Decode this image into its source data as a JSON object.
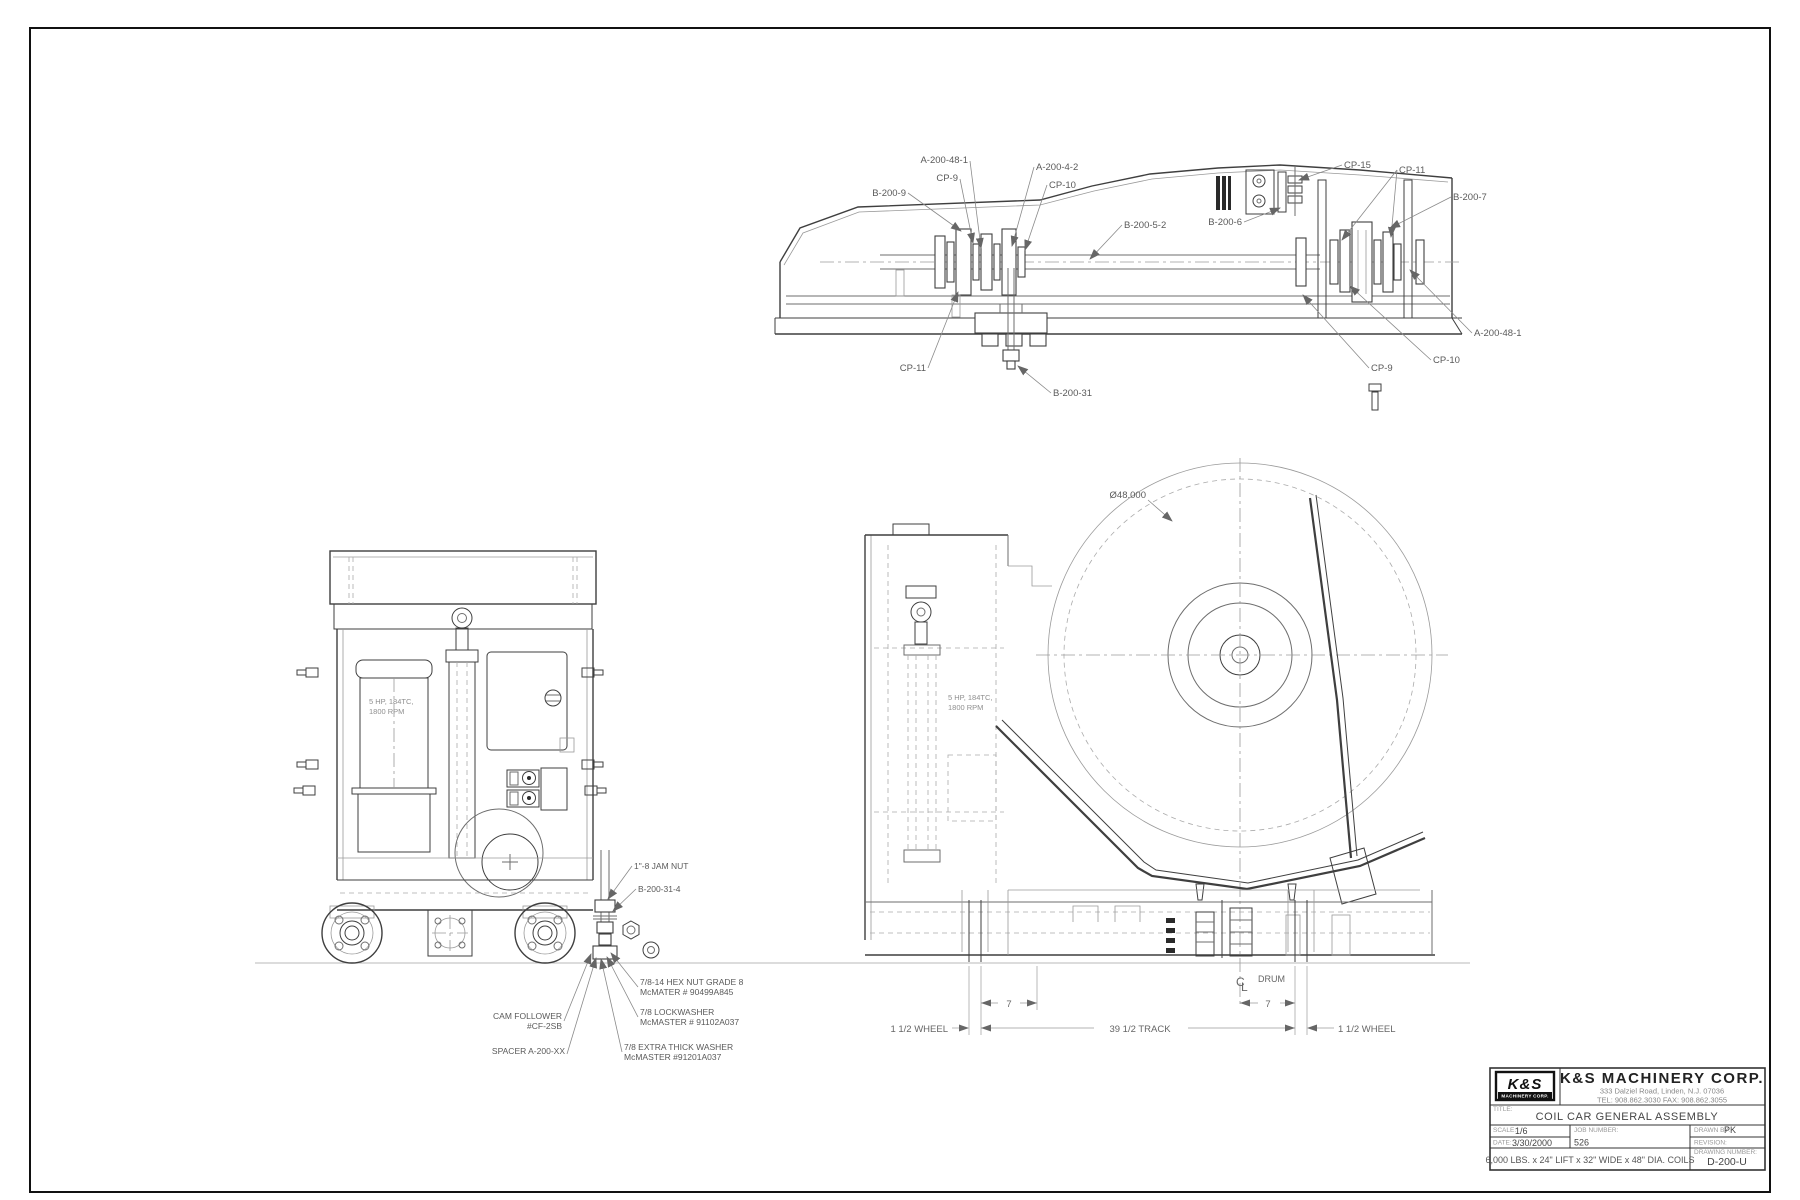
{
  "palette": {
    "ink": "#3f3f3f",
    "light_line": "#9a9a9a",
    "text": "#5a5a5a",
    "ground": "#c8c8c8",
    "background": "#ffffff"
  },
  "title_block": {
    "logo": {
      "line1": "K&S",
      "line2": "MACHINERY CORP."
    },
    "company_name": "K&S MACHINERY CORP.",
    "address": "333 Dalziel Road, Linden, N.J. 07036",
    "phone": "TEL: 908.862.3030   FAX: 908.862.3055",
    "title_label": "TITLE:",
    "title": "COIL CAR GENERAL ASSEMBLY",
    "scale_label": "SCALE:",
    "scale": "1/6",
    "date_label": "DATE:",
    "date": "3/30/2000",
    "job_label": "JOB NUMBER:",
    "job": "526",
    "drawn_label": "DRAWN BY:",
    "drawn": "PK",
    "revision_label": "REVISION:",
    "drawing_no_label": "DRAWING NUMBER:",
    "drawing_no": "D-200-U",
    "spec": "6,000 LBS. x 24\" LIFT x 32\" WIDE x 48\" DIA. COILS"
  },
  "side_view": {
    "labels": {
      "b200_9": "B-200-9",
      "cp9_top": "CP-9",
      "a200_48_1_top": "A-200-48-1",
      "a200_4_2": "A-200-4-2",
      "cp10_top": "CP-10",
      "b200_5_2": "B-200-5-2",
      "b200_6": "B-200-6",
      "cp15": "CP-15",
      "cp11_right": "CP-11",
      "b200_7": "B-200-7",
      "a200_48_1_right": "A-200-48-1",
      "cp9_bottom": "CP-9",
      "cp10_bottom": "CP-10",
      "cp11_bottom": "CP-11",
      "b200_31": "B-200-31"
    }
  },
  "front_view": {
    "motor_line1": "5 HP, 184TC,",
    "motor_line2": "1800 RPM",
    "callouts": {
      "jam_nut": "1\"-8 JAM NUT",
      "rod": "B-200-31-4",
      "hex_nut_1": "7/8-14 HEX NUT GRADE 8",
      "hex_nut_2": "McMATER # 90499A845",
      "lockwasher_1": "7/8 LOCKWASHER",
      "lockwasher_2": "McMASTER # 91102A037",
      "thick_washer_1": "7/8 EXTRA THICK WASHER",
      "thick_washer_2": "McMASTER #91201A037",
      "cam_follower_1": "CAM FOLLOWER",
      "cam_follower_2": "#CF-2SB",
      "spacer": "SPACER A-200-XX"
    }
  },
  "coil_view": {
    "coil_dia": "Ø48.000",
    "motor_line1": "5 HP, 184TC,",
    "motor_line2": "1800 RPM",
    "dims": {
      "seven_left": "7",
      "seven_right": "7",
      "track": "39 1/2 TRACK",
      "wheel_left": "1 1/2 WHEEL",
      "wheel_right": "1 1/2 WHEEL",
      "centerline_c": "C",
      "centerline_l": "L",
      "drum": "DRUM"
    }
  }
}
